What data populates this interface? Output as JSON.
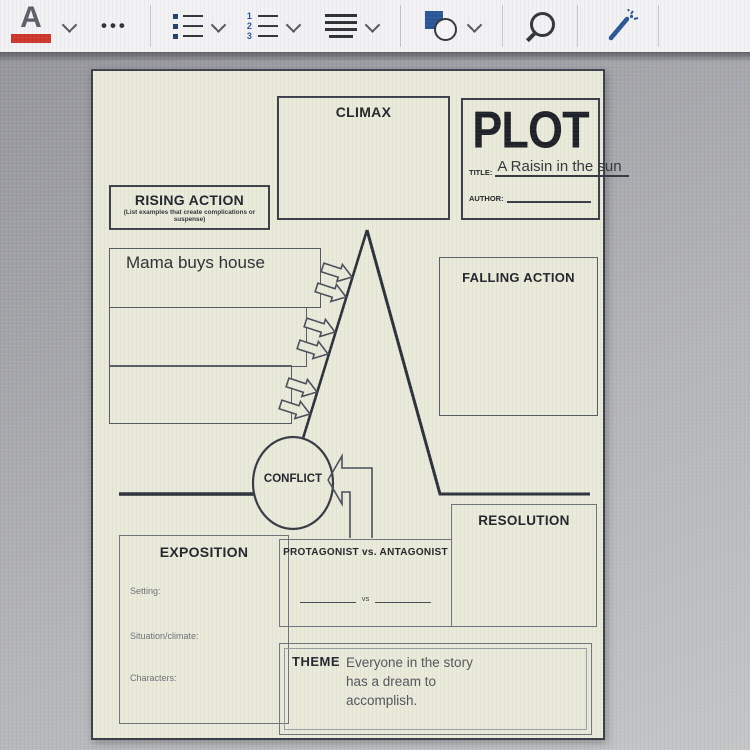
{
  "colors": {
    "accent_blue": "#2b5797",
    "swatch_red": "#ce372b",
    "paper": "#e9ead9",
    "line_dark": "#353a45"
  },
  "toolbar": {
    "font_color_label": "A",
    "more_label": "•••",
    "numbered_digits": [
      "1",
      "2",
      "3"
    ]
  },
  "worksheet": {
    "climax": {
      "label": "CLIMAX"
    },
    "plot_header": {
      "title": "PLOT",
      "title_field_label": "TITLE:",
      "title_value": "A Raisin in the sun",
      "author_field_label": "AUTHOR:"
    },
    "rising_action": {
      "label": "RISING ACTION",
      "sublabel": "(List examples that create complications or suspense)",
      "entries": [
        "Mama buys house",
        "",
        ""
      ]
    },
    "falling_action": {
      "label": "FALLING ACTION"
    },
    "conflict": {
      "label": "CONFLICT"
    },
    "resolution": {
      "label": "RESOLUTION"
    },
    "exposition": {
      "label": "EXPOSITION",
      "fields": [
        "Setting:",
        "Situation/climate:",
        "Characters:"
      ]
    },
    "protagonist_antagonist": {
      "label": "PROTAGONIST vs. ANTAGONIST",
      "vs_label": "vs"
    },
    "theme": {
      "label": "THEME",
      "value": "Everyone in the story has a dream to accomplish."
    }
  }
}
